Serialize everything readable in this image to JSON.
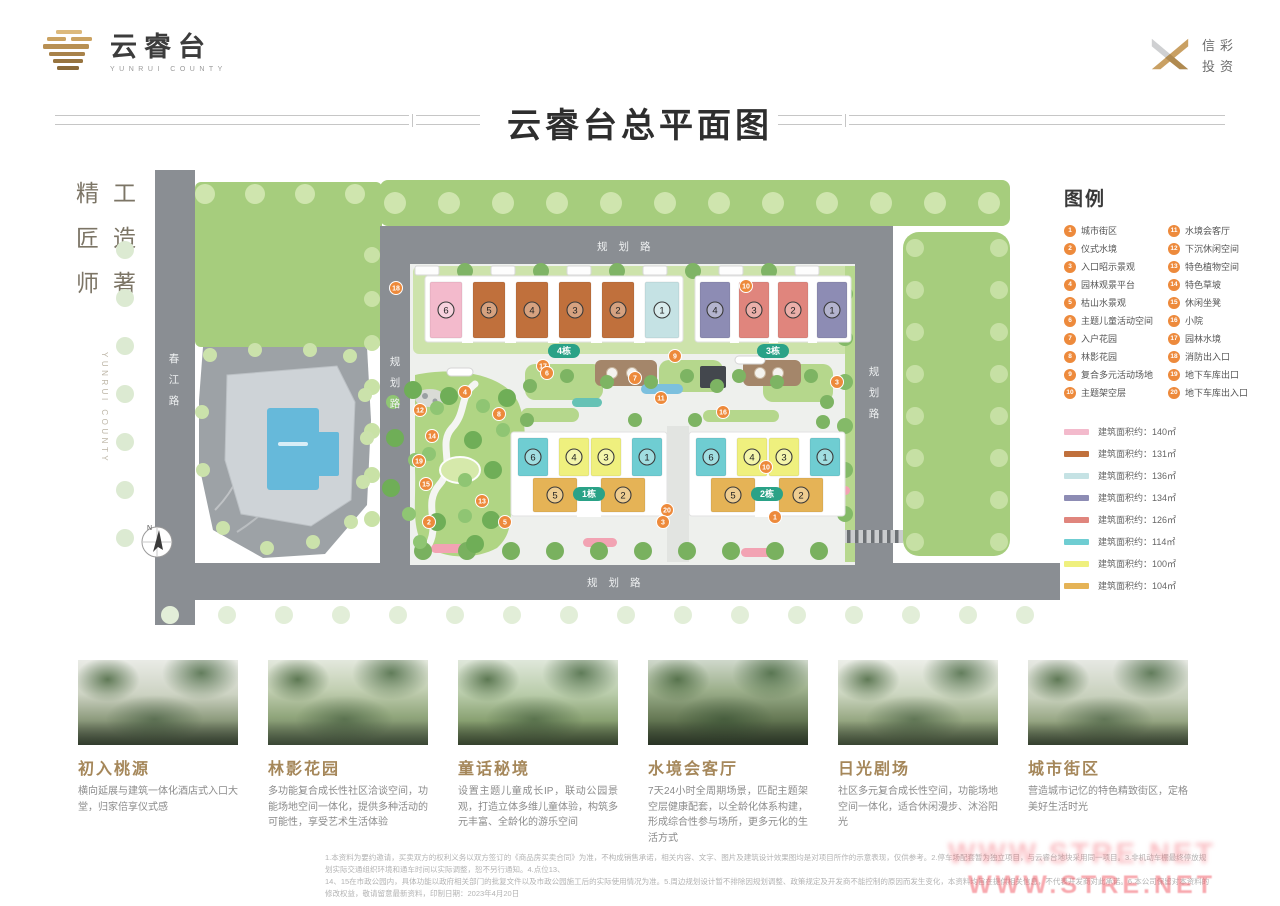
{
  "header": {
    "brand_name": "云睿台",
    "brand_sub": "YUNRUI COUNTY",
    "corp_line1": "信彩",
    "corp_line2": "投资",
    "title": "云睿台总平面图"
  },
  "side": {
    "motto_rows": [
      "精工",
      "匠造",
      "师著"
    ],
    "vertical_en": "YUNRUI COUNTY"
  },
  "map": {
    "road_labels": {
      "top": "规划路",
      "bottom": "规划路",
      "left": "春江路",
      "inner": "规划路",
      "right": "规划路"
    },
    "compass_label": "N",
    "buildings": [
      {
        "tag": "4栋",
        "tagX": 489,
        "tagY": 181,
        "base": {
          "x": 350,
          "y": 106,
          "w": 258,
          "h": 66
        },
        "units": [
          {
            "n": "6",
            "x": 355,
            "y": 112,
            "w": 32,
            "h": 56,
            "c": "#f3bacc"
          },
          {
            "n": "5",
            "x": 398,
            "y": 112,
            "w": 32,
            "h": 56,
            "c": "#c0703c"
          },
          {
            "n": "4",
            "x": 441,
            "y": 112,
            "w": 32,
            "h": 56,
            "c": "#c0703c"
          },
          {
            "n": "3",
            "x": 484,
            "y": 112,
            "w": 32,
            "h": 56,
            "c": "#c0703c"
          },
          {
            "n": "2",
            "x": 527,
            "y": 112,
            "w": 32,
            "h": 56,
            "c": "#c0703c"
          },
          {
            "n": "1",
            "x": 570,
            "y": 112,
            "w": 34,
            "h": 56,
            "c": "#c5e2e4"
          }
        ]
      },
      {
        "tag": "3栋",
        "tagX": 698,
        "tagY": 181,
        "base": {
          "x": 620,
          "y": 106,
          "w": 156,
          "h": 66
        },
        "units": [
          {
            "n": "4",
            "x": 625,
            "y": 112,
            "w": 30,
            "h": 56,
            "c": "#8d8cb4"
          },
          {
            "n": "3",
            "x": 664,
            "y": 112,
            "w": 30,
            "h": 56,
            "c": "#e0857d"
          },
          {
            "n": "2",
            "x": 703,
            "y": 112,
            "w": 30,
            "h": 56,
            "c": "#e0857d"
          },
          {
            "n": "1",
            "x": 742,
            "y": 112,
            "w": 30,
            "h": 56,
            "c": "#8d8cb4"
          }
        ]
      },
      {
        "tag": "1栋",
        "tagX": 514,
        "tagY": 324,
        "base": {
          "x": 436,
          "y": 262,
          "w": 156,
          "h": 84
        },
        "units": [
          {
            "n": "6",
            "x": 443,
            "y": 268,
            "w": 30,
            "h": 38,
            "c": "#6fcdd2"
          },
          {
            "n": "4",
            "x": 484,
            "y": 268,
            "w": 30,
            "h": 38,
            "c": "#eff07e"
          },
          {
            "n": "3",
            "x": 516,
            "y": 268,
            "w": 30,
            "h": 38,
            "c": "#eff07e"
          },
          {
            "n": "1",
            "x": 557,
            "y": 268,
            "w": 30,
            "h": 38,
            "c": "#6fcdd2"
          },
          {
            "n": "5",
            "x": 458,
            "y": 308,
            "w": 44,
            "h": 34,
            "c": "#e5b356"
          },
          {
            "n": "2",
            "x": 526,
            "y": 308,
            "w": 44,
            "h": 34,
            "c": "#e5b356"
          }
        ]
      },
      {
        "tag": "2栋",
        "tagX": 692,
        "tagY": 324,
        "base": {
          "x": 614,
          "y": 262,
          "w": 156,
          "h": 84
        },
        "units": [
          {
            "n": "6",
            "x": 621,
            "y": 268,
            "w": 30,
            "h": 38,
            "c": "#6fcdd2"
          },
          {
            "n": "4",
            "x": 662,
            "y": 268,
            "w": 30,
            "h": 38,
            "c": "#eff07e"
          },
          {
            "n": "3",
            "x": 694,
            "y": 268,
            "w": 30,
            "h": 38,
            "c": "#eff07e"
          },
          {
            "n": "1",
            "x": 735,
            "y": 268,
            "w": 30,
            "h": 38,
            "c": "#6fcdd2"
          },
          {
            "n": "5",
            "x": 636,
            "y": 308,
            "w": 44,
            "h": 34,
            "c": "#e5b356"
          },
          {
            "n": "2",
            "x": 704,
            "y": 308,
            "w": 44,
            "h": 34,
            "c": "#e5b356"
          }
        ]
      }
    ],
    "markers": [
      {
        "n": "18",
        "x": 321,
        "y": 118
      },
      {
        "n": "10",
        "x": 671,
        "y": 116
      },
      {
        "n": "9",
        "x": 600,
        "y": 186
      },
      {
        "n": "17",
        "x": 468,
        "y": 196
      },
      {
        "n": "6",
        "x": 472,
        "y": 203
      },
      {
        "n": "7",
        "x": 560,
        "y": 208
      },
      {
        "n": "3",
        "x": 762,
        "y": 212
      },
      {
        "n": "4",
        "x": 390,
        "y": 222
      },
      {
        "n": "11",
        "x": 586,
        "y": 228
      },
      {
        "n": "12",
        "x": 345,
        "y": 240
      },
      {
        "n": "8",
        "x": 424,
        "y": 244
      },
      {
        "n": "16",
        "x": 648,
        "y": 242
      },
      {
        "n": "14",
        "x": 357,
        "y": 266
      },
      {
        "n": "19",
        "x": 344,
        "y": 291
      },
      {
        "n": "10",
        "x": 691,
        "y": 297
      },
      {
        "n": "15",
        "x": 351,
        "y": 314
      },
      {
        "n": "13",
        "x": 407,
        "y": 331
      },
      {
        "n": "20",
        "x": 592,
        "y": 340
      },
      {
        "n": "2",
        "x": 354,
        "y": 352
      },
      {
        "n": "5",
        "x": 430,
        "y": 352
      },
      {
        "n": "3",
        "x": 588,
        "y": 352
      },
      {
        "n": "1",
        "x": 700,
        "y": 347
      }
    ]
  },
  "legend": {
    "title": "图例",
    "items": [
      {
        "n": "1",
        "label": "城市街区"
      },
      {
        "n": "2",
        "label": "仪式水境"
      },
      {
        "n": "3",
        "label": "入口昭示景观"
      },
      {
        "n": "4",
        "label": "园林观景平台"
      },
      {
        "n": "5",
        "label": "枯山水景观"
      },
      {
        "n": "6",
        "label": "主题儿童活动空间"
      },
      {
        "n": "7",
        "label": "入户花园"
      },
      {
        "n": "8",
        "label": "林影花园"
      },
      {
        "n": "9",
        "label": "复合多元活动场地"
      },
      {
        "n": "10",
        "label": "主题架空层"
      },
      {
        "n": "11",
        "label": "水境会客厅"
      },
      {
        "n": "12",
        "label": "下沉休闲空间"
      },
      {
        "n": "13",
        "label": "特色植物空间"
      },
      {
        "n": "14",
        "label": "特色草坡"
      },
      {
        "n": "15",
        "label": "休闲坐凳"
      },
      {
        "n": "16",
        "label": "小院"
      },
      {
        "n": "17",
        "label": "园林水境"
      },
      {
        "n": "18",
        "label": "消防出入口"
      },
      {
        "n": "19",
        "label": "地下车库出口"
      },
      {
        "n": "20",
        "label": "地下车库出入口"
      }
    ],
    "area_prefix": "建筑面积约：",
    "areas": [
      {
        "color": "#f3bacc",
        "area": "140㎡"
      },
      {
        "color": "#c0703c",
        "area": "131㎡"
      },
      {
        "color": "#c5e2e4",
        "area": "136㎡"
      },
      {
        "color": "#8d8cb4",
        "area": "134㎡"
      },
      {
        "color": "#e0857d",
        "area": "126㎡"
      },
      {
        "color": "#6fcdd2",
        "area": "114㎡"
      },
      {
        "color": "#eff07e",
        "area": "100㎡"
      },
      {
        "color": "#e5b356",
        "area": "104㎡"
      }
    ]
  },
  "features": [
    {
      "title": "初入桃源",
      "desc": "横向延展与建筑一体化酒店式入口大堂，归家倍享仪式感"
    },
    {
      "title": "林影花园",
      "desc": "多功能复合成长性社区洽谈空间，功能场地空间一体化，提供多种活动的可能性，享受艺术生活体验"
    },
    {
      "title": "童话秘境",
      "desc": "设置主题儿童成长IP，联动公园景观，打造立体多维儿童体验，构筑多元丰富、全龄化的游乐空间"
    },
    {
      "title": "水境会客厅",
      "desc": "7天24小时全周期场景，匹配主题架空层健康配套，以全龄化体系构建，形成综合性参与场所，更多元化的生活方式"
    },
    {
      "title": "日光剧场",
      "desc": "社区多元复合成长性空间，功能场地空间一体化，适合休闲漫步、沐浴阳光"
    },
    {
      "title": "城市街区",
      "desc": "营造城市记忆的特色精致街区，定格美好生活时光"
    }
  ],
  "footer": {
    "line1": "1.本资料为要约邀请，买卖双方的权利义务以双方签订的《商品房买卖合同》为准，不构成销售承诺，相关内容、文字、图片及建筑设计效果图均是对项目所作的示意表现，仅供参考。2.停车场配套暂为独立项目，与云睿台地块采用同一项目。3.非机动车棚最终停放规划实际交通组织环境和通车时间以实际调整，恕不另行通知。4.点位13、",
    "line2": "14、15在市政公园内，具体功能以政府相关部门的批复文件以及市政公园施工后的实际使用情况为准。5.周边规划设计暂不排除因规划调整、政策规定及开发商不能控制的原因而发生变化，本资料均旨在提供相关信息，不代表开发商对此承诺。6.本公司保留对本资料的修改权益，敬请留意最新资料，印制日期：2023年4月20日"
  },
  "watermark": {
    "row1": "WWW.STRE.NET",
    "row2": "WWW.STRE.NET"
  }
}
